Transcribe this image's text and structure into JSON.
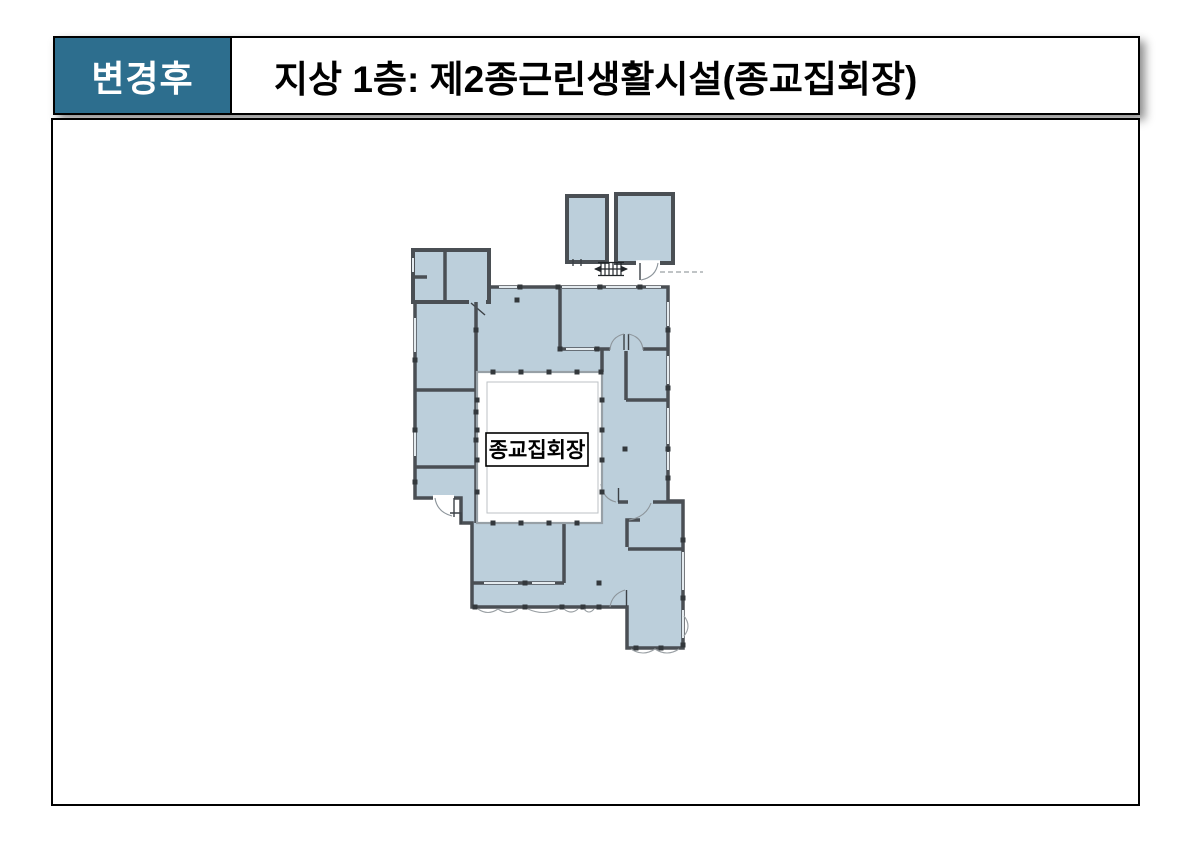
{
  "header": {
    "badge": "변경후",
    "title": "지상 1층: 제2종근린생활시설(종교집회장)"
  },
  "plan": {
    "hall_label": "종교집회장"
  },
  "colors": {
    "badge_bg": "#2d6e8e",
    "badge_text": "#ffffff",
    "room_fill": "#bccfdb",
    "wall": "#4a4f54",
    "frame_border": "#000000",
    "courtyard_fill": "#ffffff"
  }
}
